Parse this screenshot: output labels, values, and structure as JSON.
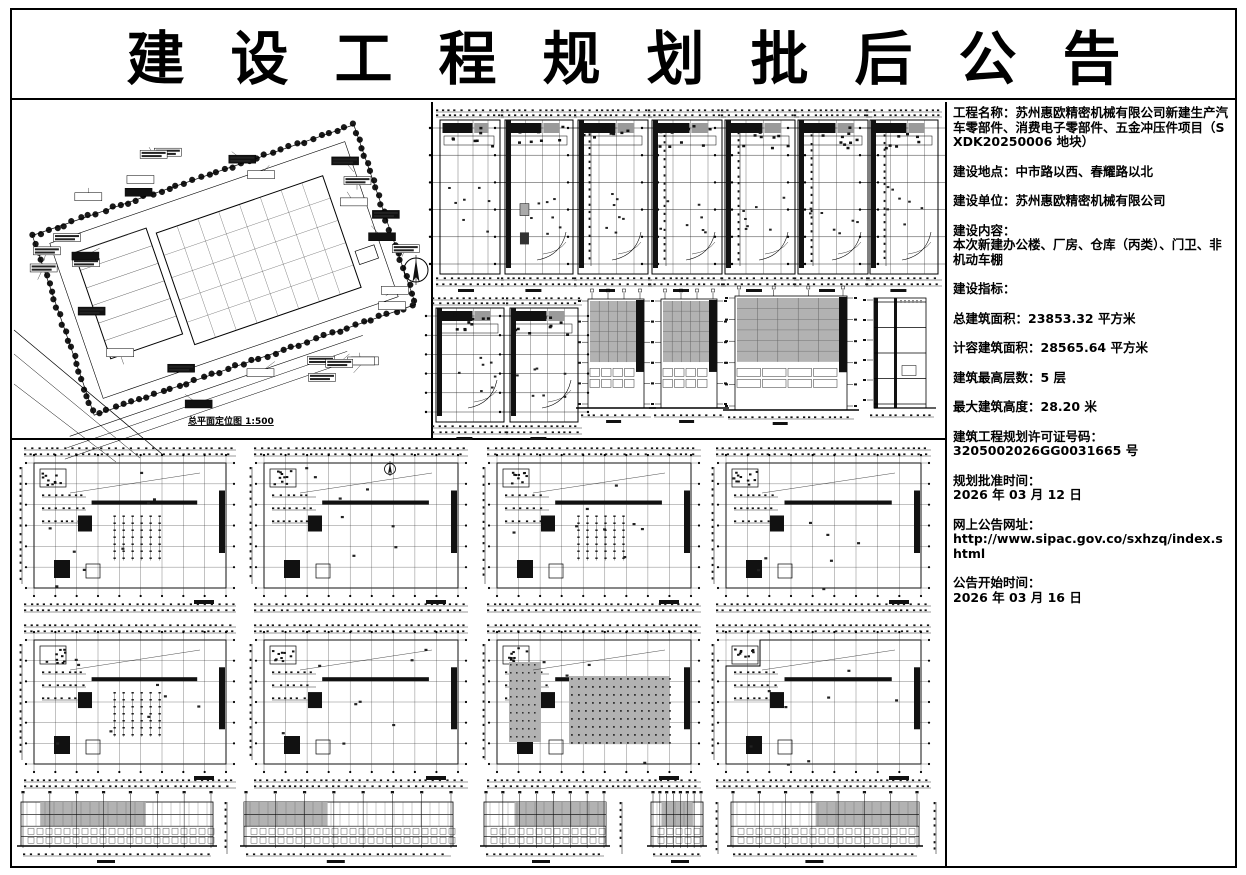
{
  "title": "建设工程规划批后公告",
  "info_panel": {
    "paragraphs": [
      {
        "lines": [
          "工程名称：苏州惠欧精密机械有限公司新建生产汽车零部件、消费电子零部件、五金冲压件项目（SXDK20250006 地块）"
        ]
      },
      {
        "lines": [
          "建设地点：中市路以西、春耀路以北"
        ]
      },
      {
        "lines": [
          "建设单位：苏州惠欧精密机械有限公司"
        ]
      },
      {
        "lines": [
          "建设内容：",
          "本次新建办公楼、厂房、仓库（丙类）、门卫、非机动车棚"
        ]
      },
      {
        "lines": [
          "建设指标："
        ]
      },
      {
        "lines": [
          "总建筑面积：23853.32 平方米"
        ]
      },
      {
        "lines": [
          "计容建筑面积：28565.64 平方米"
        ]
      },
      {
        "lines": [
          "建筑最高层数：5 层"
        ]
      },
      {
        "lines": [
          "最大建筑高度：28.20 米"
        ]
      },
      {
        "lines": [
          "建筑工程规划许可证号码：",
          "3205002026GG0031665 号"
        ]
      },
      {
        "lines": [
          "规划批准时间：",
          "2026 年 03 月 12 日"
        ]
      },
      {
        "lines": [
          "网上公告网址：",
          "http://www.sipac.gov.co/sxhzq/index.shtml"
        ]
      },
      {
        "lines": [
          "公告开始时间：",
          "2026 年 03 月 16 日"
        ]
      }
    ]
  },
  "drawings": {
    "site_plan": {
      "caption": "总平面定位图 1:500"
    },
    "colors": {
      "ink": "#000000",
      "facade_gray": "#b2b2b2",
      "dark_fill": "#111111"
    },
    "icons": [
      "compass-icon"
    ],
    "layout": {
      "top_row1_narrow_plans": 7,
      "top_row2_narrow_plans": 2,
      "top_row2_elevations": 4,
      "bottom_plan_rows": 2,
      "bottom_plans_per_row": 4,
      "bottom_elevations": 5
    }
  }
}
